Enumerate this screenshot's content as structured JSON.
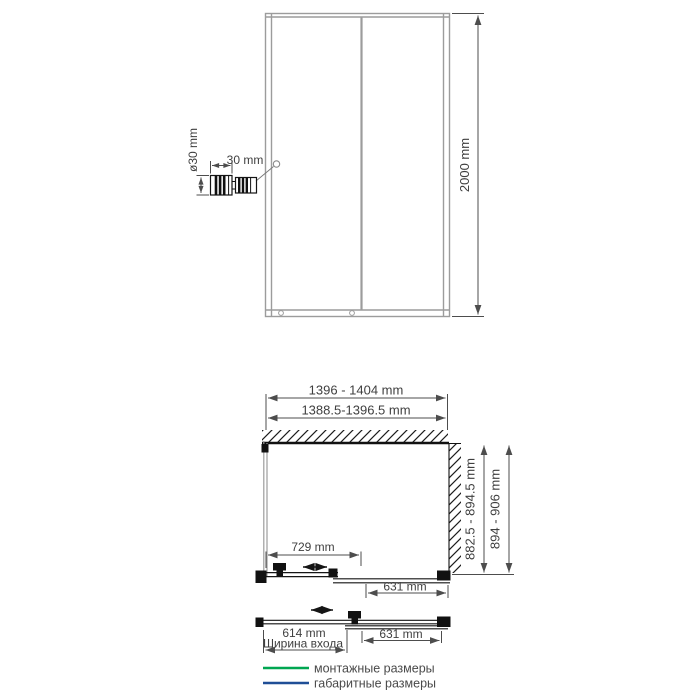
{
  "front_view": {
    "height_label": "2000 mm",
    "handle_detail": {
      "diameter_label": "ø30 mm",
      "width_label": "30 mm"
    }
  },
  "plan_view": {
    "overall_width_label": "1396 - 1404 mm",
    "mounting_width_label": "1388.5-1396.5 mm",
    "mounting_depth_label": "882.5 - 894.5 mm",
    "overall_depth_label": "894 - 906 mm",
    "sliding_panel_label": "729 mm",
    "fixed_panel_label": "631 mm"
  },
  "open_view": {
    "entrance_width_label": "614 mm",
    "entrance_caption": "Ширина входа",
    "fixed_panel_label": "631 mm"
  },
  "legend": {
    "items": [
      {
        "label": "монтажные размеры",
        "color": "#00a651"
      },
      {
        "label": "габаритные размеры",
        "color": "#1f4e96"
      }
    ]
  },
  "colors": {
    "mounting_green": "#00a651",
    "overall_blue": "#2e5d9b",
    "dim_text": "#3f3f3f",
    "frame_gray": "#9c9c9c"
  }
}
